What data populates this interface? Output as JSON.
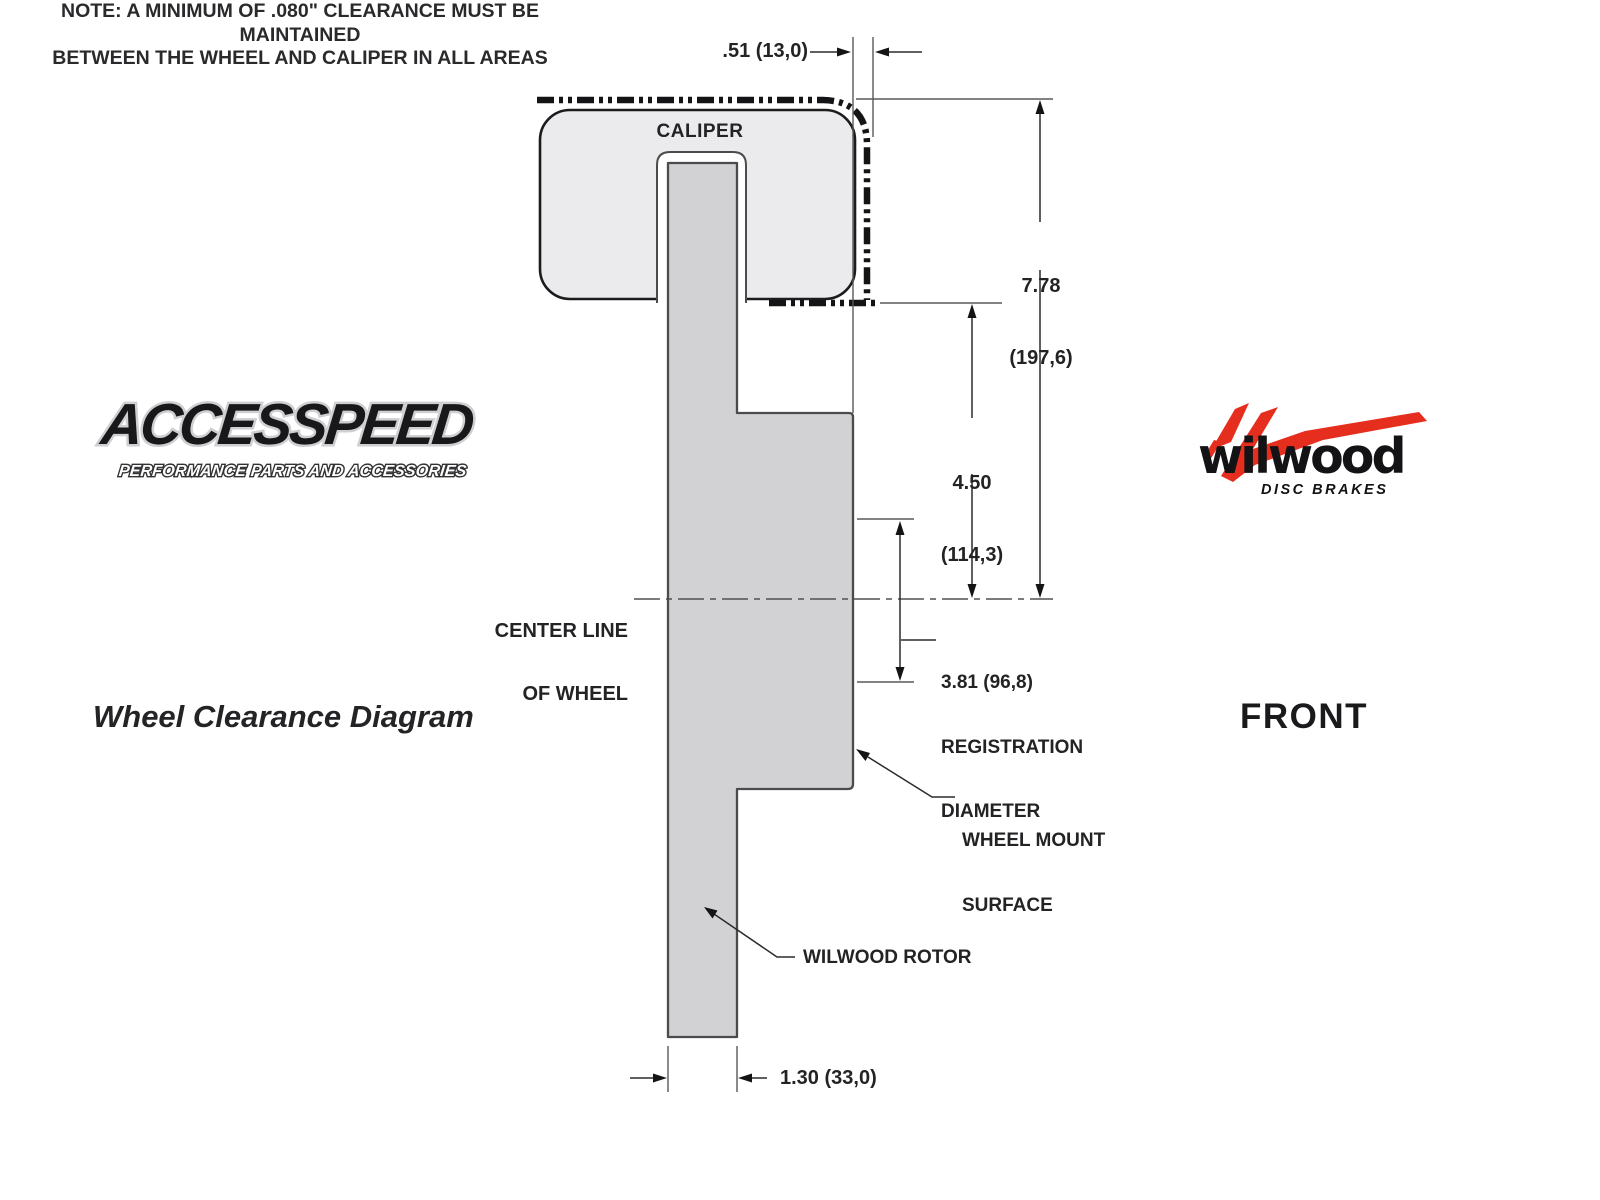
{
  "branding": {
    "accesspeed_name": "ACCESSPEED",
    "accesspeed_tagline": "PERFORMANCE PARTS AND ACCESSORIES",
    "wilwood_name": "wilwood",
    "wilwood_tagline": "DISC BRAKES",
    "wilwood_red": "#e62e1e"
  },
  "captions": {
    "left_title": "Wheel Clearance Diagram",
    "view_label": "FRONT",
    "note_line1": "NOTE: A MINIMUM OF .080\" CLEARANCE MUST BE MAINTAINED",
    "note_line2": "BETWEEN THE WHEEL AND CALIPER IN ALL AREAS"
  },
  "diagram": {
    "labels": {
      "caliper": "CALIPER",
      "center_line_1": "CENTER LINE",
      "center_line_2": "OF WHEEL",
      "wheel_mount_1": "WHEEL MOUNT",
      "wheel_mount_2": "SURFACE",
      "rotor": "WILWOOD ROTOR"
    },
    "dimensions": {
      "caliper_to_wheel_clearance": ".51 (13,0)",
      "wheel_to_centerline_in": "7.78",
      "wheel_to_centerline_mm": "(197,6)",
      "mount_to_centerline_in": "4.50",
      "mount_to_centerline_mm": "(114,3)",
      "registration_value": "3.81 (96,8)",
      "registration_word1": "REGISTRATION",
      "registration_word2": "DIAMETER",
      "rotor_width": "1.30 (33,0)"
    },
    "colors": {
      "caliper_fill": "#ebebed",
      "rotor_fill": "#d2d2d5",
      "line_color": "#2a2a2c"
    }
  }
}
